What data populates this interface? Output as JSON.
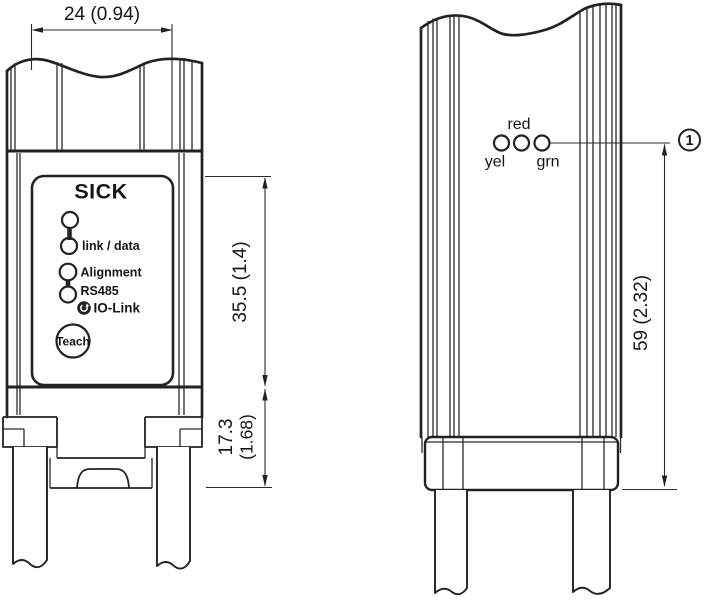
{
  "drawing": {
    "kind": "sensor dimensional drawing, two views",
    "line_color": "#222222",
    "background": "#ffffff"
  },
  "left_view": {
    "brand": "SICK",
    "panel": {
      "link_data_label": "link / data",
      "alignment_label": "Alignment",
      "rs485_label": "RS485",
      "io_link_label": "IO-Link",
      "teach_label": "Teach"
    },
    "dimensions": {
      "width": "24 (0.94)",
      "front_height": "35.5 (1.4)",
      "lower_height_mm": "17.3",
      "lower_height_in": "(1.68)"
    }
  },
  "right_view": {
    "leds": {
      "red": "red",
      "yel": "yel",
      "grn": "grn"
    },
    "dimensions": {
      "height": "59 (2.32)"
    },
    "callout_1": "1"
  }
}
